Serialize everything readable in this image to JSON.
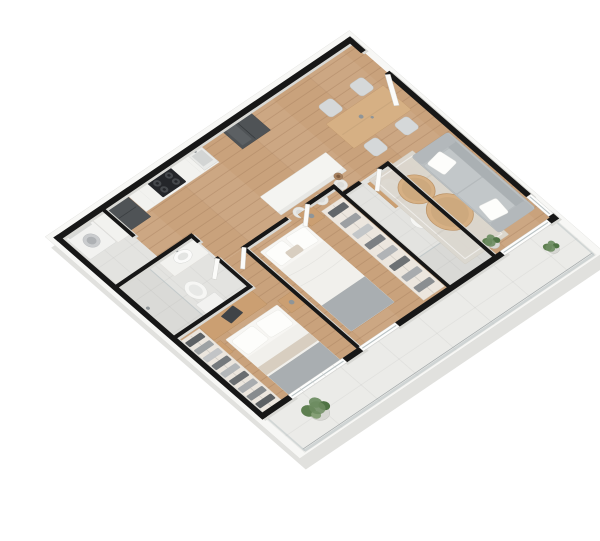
{
  "title": "3D isometric floor plan of a two-bedroom apartment with balcony",
  "view": {
    "projection": "isometric-3d",
    "background": "#ffffff",
    "width_px": 600,
    "height_px": 541
  },
  "colors": {
    "wall": "#171717",
    "wallSide": "#d9d9d5",
    "slab": "#f7f7f5",
    "slabShadow": "#d9d9d6",
    "woodFloor": "#c9a27c",
    "tileFloor": "#e3e3e0",
    "balconyFloor": "#ebebe8",
    "counter": "#f2f2ef",
    "island": "#f4f4f1",
    "appliance": "#4f5356",
    "cooktop": "#24262a",
    "sofa": "#babfc1",
    "cushion": "#c2c7c9",
    "pillow": "#fdfdfb",
    "duvet": "#f1f0ec",
    "blanket": "#a9aeb1",
    "throw": "#d8cec0",
    "woodFurniture": "#cb9f72",
    "woodTable": "#d6b084",
    "chair": "#d5d8d9",
    "rug": "#dcd8d0",
    "fixture": "#f2f2f0",
    "glass": "#b9c2c4",
    "pot": "#d7d7d3",
    "metal": "#8f9598",
    "plant": "#6d8c60",
    "plantDark": "#4f7344",
    "plantLight": "#86a077"
  },
  "rooms": [
    {
      "id": "laundry",
      "name": "Laundry nook",
      "floor": "tile",
      "furniture": [
        "washing machine",
        "counter"
      ]
    },
    {
      "id": "kitchen",
      "name": "Kitchen",
      "floor": "wood",
      "furniture": [
        "refrigerator",
        "wall counter",
        "cooktop with 4 burners",
        "sink",
        "tall dark cabinet unit",
        "island with 3 bar stools"
      ]
    },
    {
      "id": "entry",
      "name": "Entry hall",
      "floor": "wood",
      "furniture": [
        "entrance door",
        "decor vase"
      ]
    },
    {
      "id": "dining",
      "name": "Dining area",
      "floor": "wood",
      "furniture": [
        "wood dining table",
        "4 chairs"
      ]
    },
    {
      "id": "living",
      "name": "Living room",
      "floor": "wood",
      "furniture": [
        "gray sofa with 2 white pillows",
        "2 round wood coffee tables",
        "area rug",
        "potted plant",
        "corner window"
      ]
    },
    {
      "id": "bathroom1",
      "name": "Bathroom 1",
      "floor": "tile",
      "furniture": [
        "glass shower",
        "toilet",
        "vanity sink"
      ]
    },
    {
      "id": "bedroom2",
      "name": "Bedroom 2",
      "floor": "wood",
      "furniture": [
        "double bed",
        "nightstand with lamp",
        "open closet with hanging clothes"
      ]
    },
    {
      "id": "bathroom2",
      "name": "Bathroom 2",
      "floor": "tile",
      "furniture": [
        "wood vanity with sink",
        "toilet",
        "glass shower"
      ]
    },
    {
      "id": "master",
      "name": "Master bedroom",
      "floor": "wood",
      "furniture": [
        "double bed",
        "desk with laptop",
        "office chair",
        "2 nightstands",
        "open wardrobe with hanging clothes",
        "balcony window"
      ]
    },
    {
      "id": "balcony",
      "name": "Balcony",
      "floor": "large tiles",
      "furniture": [
        "glass railing",
        "large potted plant",
        "small potted plant"
      ]
    }
  ],
  "counts": {
    "bedrooms": 2,
    "bathrooms": 2,
    "bar_stools": 3,
    "dining_chairs": 4,
    "plants": 4,
    "interior_doors": 4,
    "windows": 4
  }
}
